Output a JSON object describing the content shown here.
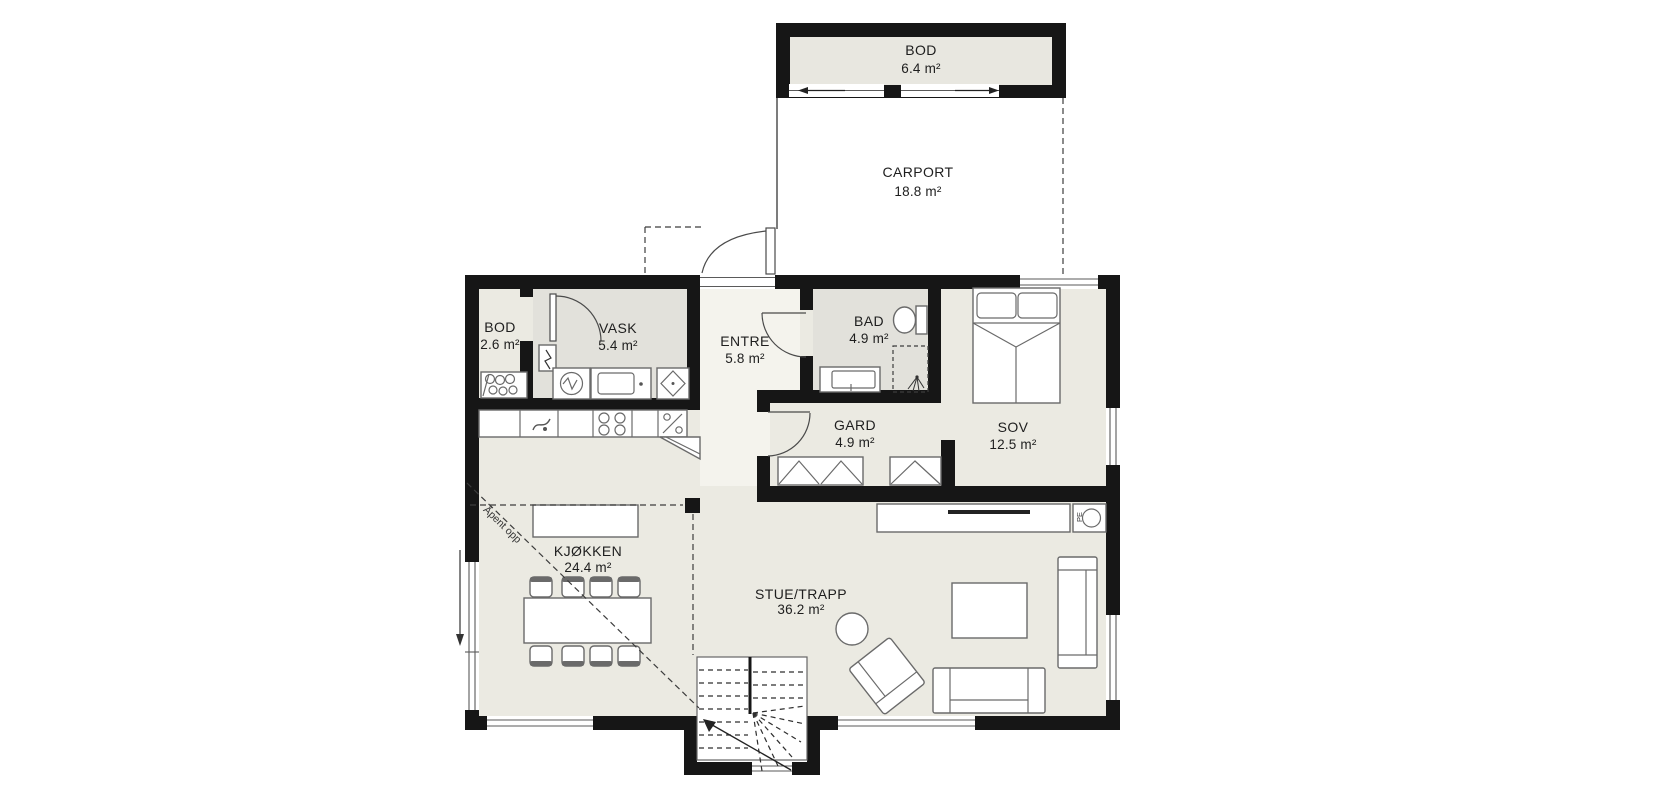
{
  "plan": {
    "rooms": [
      {
        "id": "bod-storage",
        "label": "BOD",
        "area": "6.4 m²"
      },
      {
        "id": "carport",
        "label": "CARPORT",
        "area": "18.8 m²"
      },
      {
        "id": "bod",
        "label": "BOD",
        "area": "2.6 m²"
      },
      {
        "id": "vask",
        "label": "VASK",
        "area": "5.4 m²"
      },
      {
        "id": "entre",
        "label": "ENTRE",
        "area": "5.8 m²"
      },
      {
        "id": "bad",
        "label": "BAD",
        "area": "4.9 m²"
      },
      {
        "id": "gard",
        "label": "GARD",
        "area": "4.9 m²"
      },
      {
        "id": "sov",
        "label": "SOV",
        "area": "12.5 m²"
      },
      {
        "id": "kjokken",
        "label": "KJØKKEN",
        "area": "24.4 m²"
      },
      {
        "id": "stue",
        "label": "STUE/TRAPP",
        "area": "36.2 m²"
      }
    ],
    "annotations": {
      "open_above": "Åpent opp",
      "fireplace_badge": "PE"
    },
    "colors": {
      "wall": "#161616",
      "room_fill": "#ebeae2",
      "wet_room_fill": "#e2e1db",
      "entre_fill": "#f4f3ed",
      "outbuilding_fill": "#e8e7e0",
      "background": "#ffffff",
      "furniture_stroke": "#6a6a6a"
    }
  }
}
